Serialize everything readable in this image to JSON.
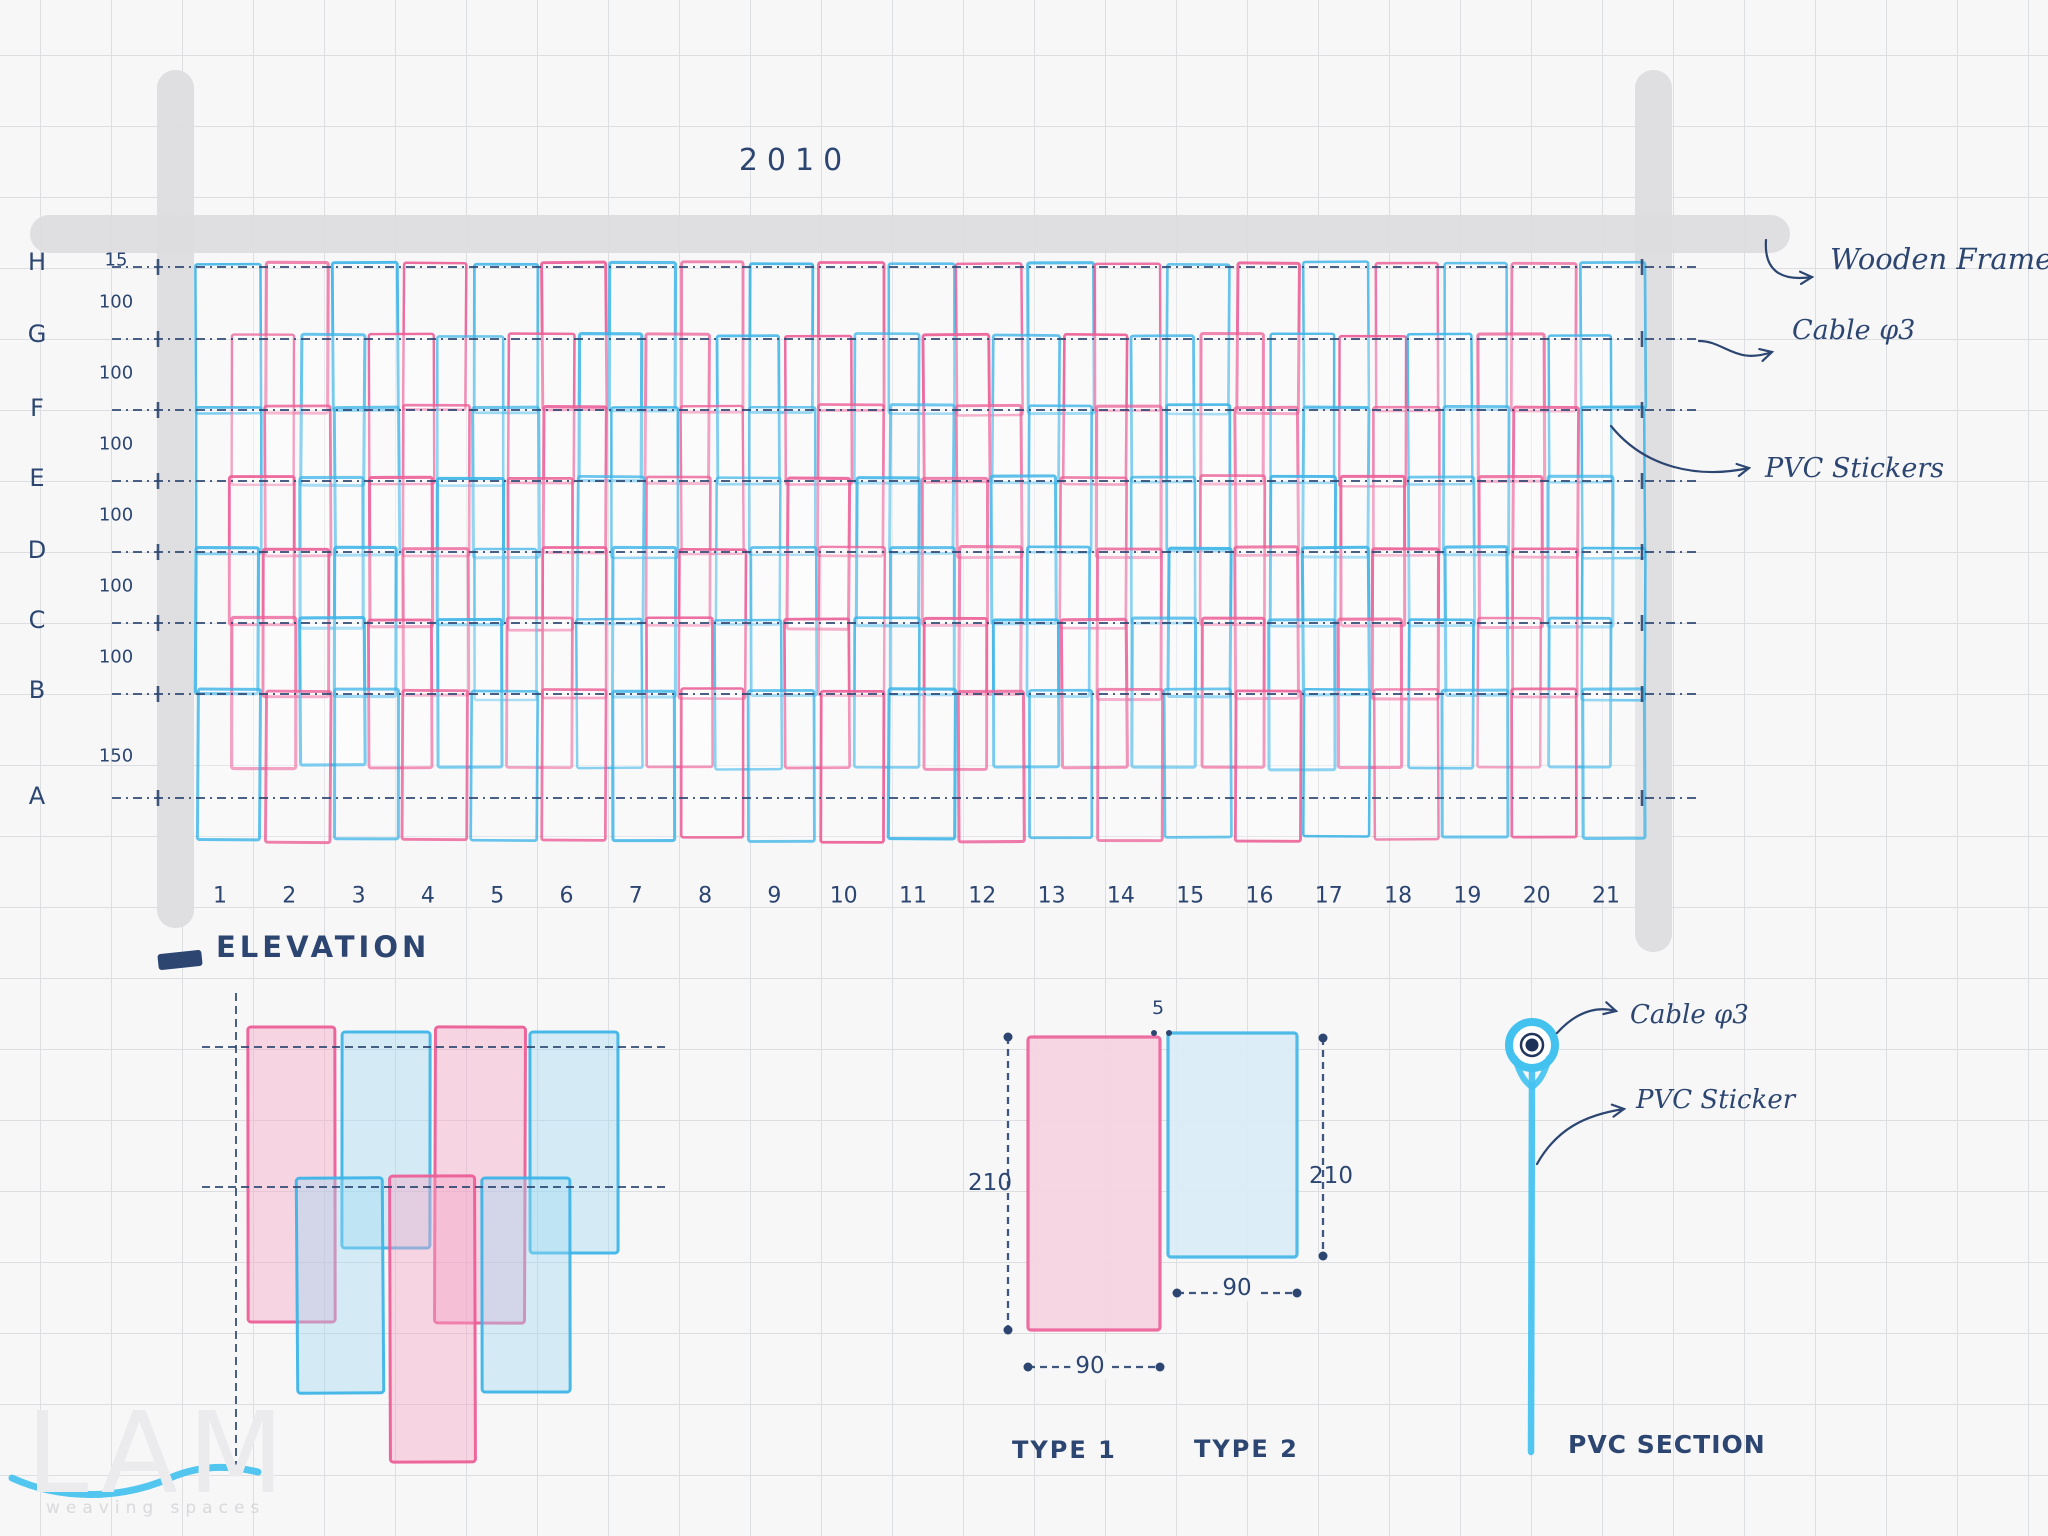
{
  "sheet": {
    "overall_width_label": "2010",
    "elevation_title": "ELEVATION",
    "grid_rows": {
      "labels": [
        "H",
        "G",
        "F",
        "E",
        "D",
        "C",
        "B",
        "A"
      ],
      "spacing_dims": [
        "15",
        "100",
        "100",
        "100",
        "100",
        "100",
        "100",
        "150"
      ]
    },
    "grid_columns": [
      "1",
      "2",
      "3",
      "4",
      "5",
      "6",
      "7",
      "8",
      "9",
      "10",
      "11",
      "12",
      "13",
      "14",
      "15",
      "16",
      "17",
      "18",
      "19",
      "20",
      "21"
    ],
    "callouts": {
      "wooden_frame": "Wooden Frame",
      "cable_top": "Cable φ3",
      "pvc_stickers": "PVC Stickers"
    },
    "type_detail": {
      "type1_label": "TYPE 1",
      "type2_label": "TYPE 2",
      "height1": "210",
      "height2": "210",
      "width1": "90",
      "width2": "90",
      "gap": "5"
    },
    "section_detail": {
      "cable_label": "Cable φ3",
      "sticker_label": "PVC Sticker",
      "title": "PVC SECTION"
    },
    "logo": {
      "name": "LAM",
      "tagline": "weaving spaces"
    },
    "colors": {
      "pink": "#ec5f97",
      "blue": "#3eb5e8",
      "ink": "#2c4671",
      "frame_gray": "#dcdcde",
      "pvc_cyan": "#43c2f0",
      "paper": "#f7f7f8"
    }
  }
}
